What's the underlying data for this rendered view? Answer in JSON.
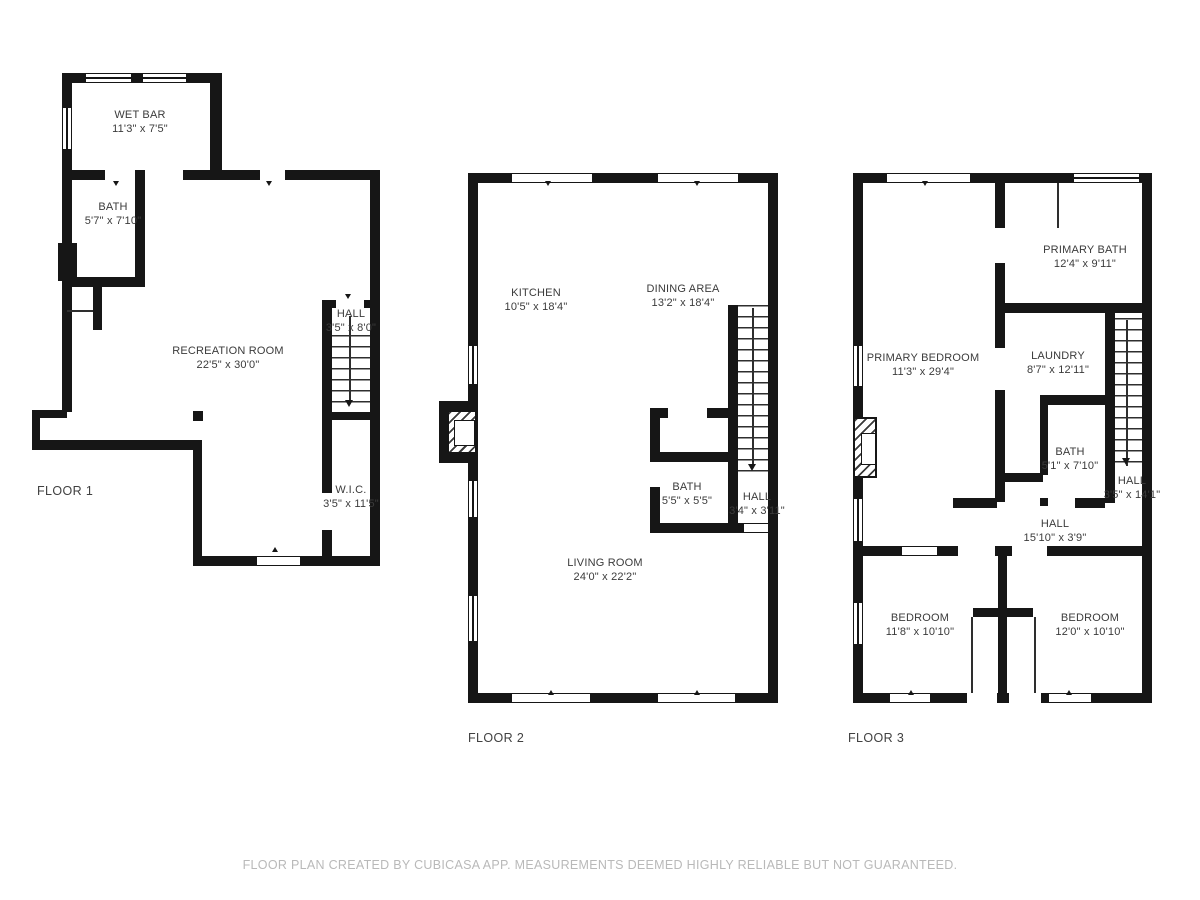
{
  "colors": {
    "wall": "#161616",
    "room_label": "#3b3b3b",
    "floor_label": "#414141",
    "footer_text": "#b9b9b9",
    "background": "#ffffff"
  },
  "floors": [
    {
      "label": "FLOOR 1",
      "rooms": [
        {
          "name": "WET BAR",
          "dims": "11'3\" x 7'5\""
        },
        {
          "name": "BATH",
          "dims": "5'7\" x 7'10\""
        },
        {
          "name": "HALL",
          "dims": "3'5\" x 8'0\""
        },
        {
          "name": "RECREATION ROOM",
          "dims": "22'5\" x 30'0\""
        },
        {
          "name": "W.I.C.",
          "dims": "3'5\" x 11'5\""
        }
      ]
    },
    {
      "label": "FLOOR 2",
      "rooms": [
        {
          "name": "KITCHEN",
          "dims": "10'5\" x 18'4\""
        },
        {
          "name": "DINING AREA",
          "dims": "13'2\" x 18'4\""
        },
        {
          "name": "BATH",
          "dims": "5'5\" x 5'5\""
        },
        {
          "name": "HALL",
          "dims": "3'4\" x 3'11\""
        },
        {
          "name": "LIVING ROOM",
          "dims": "24'0\" x 22'2\""
        }
      ]
    },
    {
      "label": "FLOOR 3",
      "rooms": [
        {
          "name": "PRIMARY BATH",
          "dims": "12'4\" x 9'11\""
        },
        {
          "name": "PRIMARY BEDROOM",
          "dims": "11'3\" x 29'4\""
        },
        {
          "name": "LAUNDRY",
          "dims": "8'7\" x 12'11\""
        },
        {
          "name": "BATH",
          "dims": "5'1\" x 7'10\""
        },
        {
          "name": "HALL",
          "dims": "3'5\" x 14'1\""
        },
        {
          "name": "HALL",
          "dims": "15'10\" x 3'9\""
        },
        {
          "name": "BEDROOM",
          "dims": "11'8\" x 10'10\""
        },
        {
          "name": "BEDROOM",
          "dims": "12'0\" x 10'10\""
        }
      ]
    }
  ],
  "footer": "FLOOR PLAN CREATED BY CUBICASA APP. MEASUREMENTS DEEMED HIGHLY RELIABLE BUT NOT GUARANTEED."
}
